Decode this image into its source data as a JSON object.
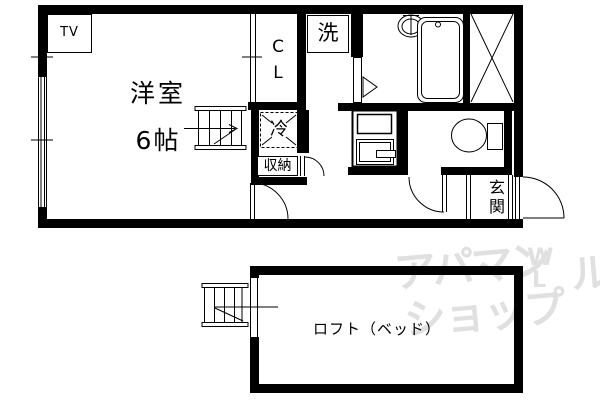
{
  "colors": {
    "line": "#000000",
    "background": "#ffffff",
    "watermark": "#e0e0e0"
  },
  "floor_plan": {
    "labels": {
      "room1": "洋室",
      "room1_size": "6帖",
      "tv": "TV",
      "closet": "CL",
      "washer": "洗",
      "fridge": "冷",
      "storage": "収納",
      "entrance": "玄関",
      "loft": "ロフト（ベッド）"
    }
  },
  "watermark": {
    "line1": "アパマン",
    "line2": "ショップ",
    "mark_w": "W",
    "mark_l": "L",
    "edge_glyph": "ル"
  }
}
